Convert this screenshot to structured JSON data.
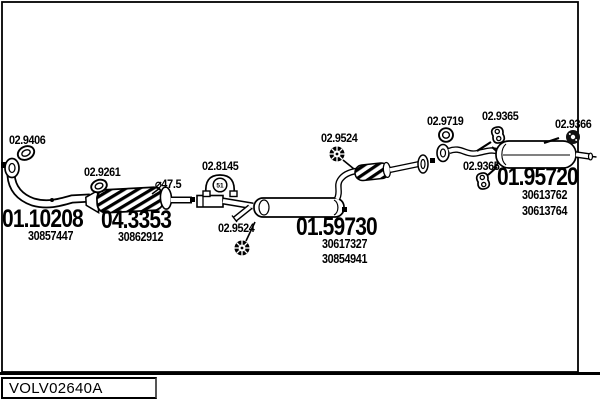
{
  "diagram": {
    "hardware_labels": [
      {
        "name": "clamp",
        "label": "02.9406"
      },
      {
        "name": "sealing-ring",
        "label": "02.9261"
      },
      {
        "name": "mount-bracket",
        "label": "02.8145",
        "bracket_mark": "51"
      },
      {
        "name": "lock-washer-front",
        "label": "02.9524"
      },
      {
        "name": "lock-washer-mid",
        "label": "02.9524"
      },
      {
        "name": "flange-gasket",
        "label": "02.9719"
      },
      {
        "name": "rubber-hanger-top",
        "label": "02.9365"
      },
      {
        "name": "grommet",
        "label": "02.9366"
      },
      {
        "name": "rubber-hanger-low",
        "label": "02.9365"
      }
    ],
    "assemblies": [
      {
        "name": "front-pipe",
        "code": "01.10208",
        "oem": [
          "30857447"
        ]
      },
      {
        "name": "catalytic-converter",
        "code": "04.3353",
        "oem": [
          "30862912"
        ],
        "note": "⌀47.5"
      },
      {
        "name": "centre-silencer",
        "code": "01.59730",
        "oem": [
          "30617327",
          "30854941"
        ]
      },
      {
        "name": "rear-silencer",
        "code": "01.95720",
        "oem": [
          "30613762",
          "30613764"
        ]
      }
    ]
  },
  "footer": {
    "drawing_code": "VOLV02640A"
  },
  "colors": {
    "line": "#000000",
    "background": "#ffffff"
  }
}
